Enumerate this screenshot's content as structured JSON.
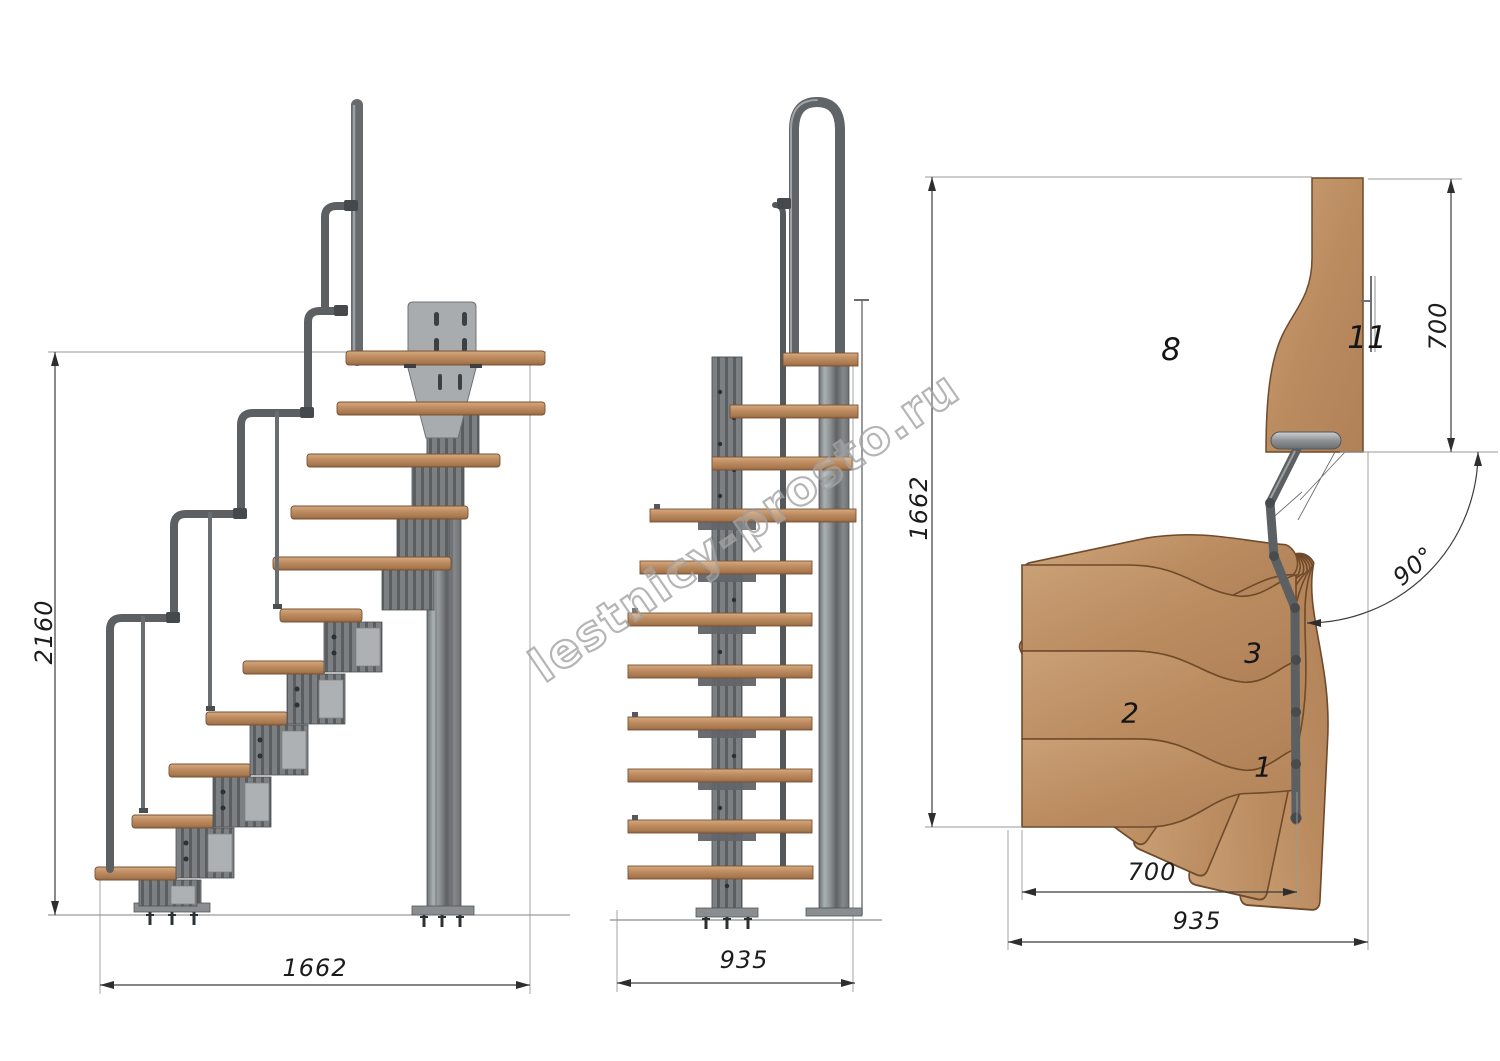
{
  "watermark": {
    "text": "lestnicy-prosto.ru"
  },
  "views": {
    "side_elevation": {
      "dim_height_mm": "2160",
      "dim_length_mm": "1662"
    },
    "front_elevation": {
      "dim_width_mm": "935"
    },
    "plan": {
      "dim_depth_mm": "1662",
      "dim_exit_width_mm": "700",
      "dim_tread_width_mm": "700",
      "dim_total_width_mm": "935",
      "dim_turn_angle": "90°",
      "step_numbers": [
        "1",
        "2",
        "3",
        "8",
        "11"
      ]
    }
  },
  "colors": {
    "wood": "#c09167",
    "wood_dark_edge": "#7a5233",
    "metal": "#7e8284",
    "metal_dark": "#55585a",
    "dimension_line": "#3c3c3c",
    "extension_line": "#9a9a9a",
    "watermark_gray": "#a3a3a3",
    "background": "#ffffff"
  }
}
